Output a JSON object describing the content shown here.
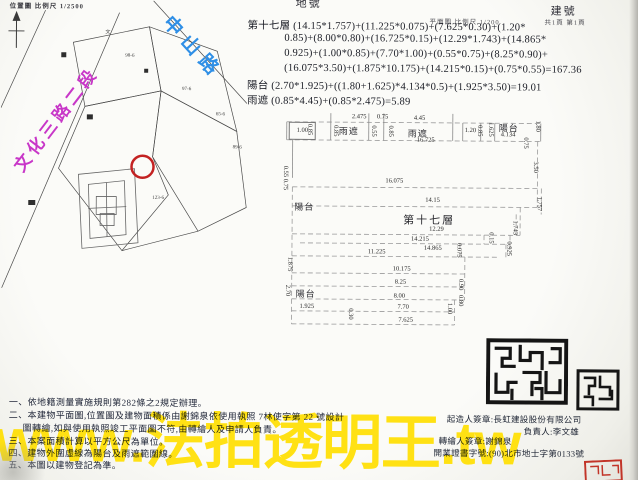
{
  "header": {
    "location_caption": "位置圖 比例尺 1/2500",
    "lot_no_label": "地號",
    "building_no_label": "建號",
    "plan_scale": "平面圖 比例尺 1/200",
    "page_info": "共1頁 第1頁"
  },
  "site_plan": {
    "road_blue": "中山路",
    "road_magenta": "文化三路二段",
    "labels": [
      {
        "t": "文",
        "x": 104,
        "y": 30
      },
      {
        "t": "98-6",
        "x": 124,
        "y": 55
      },
      {
        "t": "97-6",
        "x": 181,
        "y": 88
      },
      {
        "t": "65-6",
        "x": 215,
        "y": 113
      },
      {
        "t": "89-6",
        "x": 232,
        "y": 146
      },
      {
        "t": "123-6",
        "x": 152,
        "y": 197
      }
    ]
  },
  "calc": {
    "lines": [
      {
        "t": "第十七層 (14.15*1.757)+(11.225*0.075)+(7.625*0.30)+(1.20*",
        "x": 246,
        "y": 18
      },
      {
        "t": "0.85)+(8.00*0.80)+(16.725*0.15)+(12.29*1.743)+(14.865*",
        "x": 283,
        "y": 33
      },
      {
        "t": "0.925)+(1.00*0.85)+(7.70*1.00)+(0.55*0.75)+(8.25*0.90)+",
        "x": 283,
        "y": 48
      },
      {
        "t": "(16.075*3.50)+(1.875*10.175)+(14.215*0.15)+(0.75*0.55)=167.36",
        "x": 283,
        "y": 63
      },
      {
        "t": "陽台 (2.70*1.925)+((1.80+1.625)*4.134*0.5)+(1.925*3.50)=19.01",
        "x": 246,
        "y": 78
      },
      {
        "t": "雨遮 (0.85*4.45)+(0.85*2.475)=5.89",
        "x": 246,
        "y": 93
      }
    ]
  },
  "floor_plan": {
    "box_dim": "1.00",
    "labels": [
      {
        "t": "雨遮",
        "x": 338,
        "y": 124
      },
      {
        "t": "雨遮",
        "x": 407,
        "y": 126
      },
      {
        "t": "陽台",
        "x": 498,
        "y": 120
      },
      {
        "t": "陽台",
        "x": 294,
        "y": 200
      },
      {
        "t": "第十七層",
        "x": 403,
        "y": 211,
        "big": 1
      },
      {
        "t": "陽台",
        "x": 296,
        "y": 287
      }
    ],
    "dims": [
      {
        "t": "2.475",
        "x": 351,
        "y": 114
      },
      {
        "t": "0.75",
        "x": 376,
        "y": 114
      },
      {
        "t": "4.45",
        "x": 413,
        "y": 115
      },
      {
        "t": "16.725",
        "x": 416,
        "y": 137
      },
      {
        "t": "0.85",
        "x": 305,
        "y": 124,
        "v": 1
      },
      {
        "t": "0.85",
        "x": 331,
        "y": 125,
        "v": 1
      },
      {
        "t": "0.55",
        "x": 369,
        "y": 125,
        "v": 1
      },
      {
        "t": "0.85",
        "x": 386,
        "y": 125,
        "v": 1
      },
      {
        "t": "1.20",
        "x": 464,
        "y": 127
      },
      {
        "t": "0.85",
        "x": 475,
        "y": 124,
        "v": 1
      },
      {
        "t": "1.625",
        "x": 486,
        "y": 121,
        "v": 1
      },
      {
        "t": "4.134",
        "x": 500,
        "y": 131
      },
      {
        "t": "1.80",
        "x": 533,
        "y": 119,
        "v": 1
      },
      {
        "t": "0.75",
        "x": 521,
        "y": 136,
        "v": 1
      },
      {
        "t": "3.50",
        "x": 531,
        "y": 160,
        "v": 1
      },
      {
        "t": "0.55",
        "x": 281,
        "y": 166,
        "v": 1
      },
      {
        "t": "0.75",
        "x": 281,
        "y": 179,
        "v": 1
      },
      {
        "t": "16.075",
        "x": 385,
        "y": 178
      },
      {
        "t": "14.15",
        "x": 425,
        "y": 197
      },
      {
        "t": "12.29",
        "x": 429,
        "y": 226
      },
      {
        "t": "14.215",
        "x": 411,
        "y": 236
      },
      {
        "t": "14.865",
        "x": 424,
        "y": 245
      },
      {
        "t": "11.225",
        "x": 368,
        "y": 249
      },
      {
        "t": "1.757",
        "x": 535,
        "y": 195,
        "v": 1
      },
      {
        "t": "1.743",
        "x": 511,
        "y": 219,
        "v": 1
      },
      {
        "t": "0.15",
        "x": 487,
        "y": 231,
        "v": 1
      },
      {
        "t": "0.925",
        "x": 505,
        "y": 240,
        "v": 1
      },
      {
        "t": "0.075",
        "x": 455,
        "y": 242,
        "v": 1
      },
      {
        "t": "1.875",
        "x": 286,
        "y": 257,
        "v": 1
      },
      {
        "t": "10.175",
        "x": 393,
        "y": 266
      },
      {
        "t": "8.25",
        "x": 395,
        "y": 279
      },
      {
        "t": "0.90",
        "x": 457,
        "y": 278,
        "v": 1
      },
      {
        "t": "2.70",
        "x": 284,
        "y": 285,
        "v": 1
      },
      {
        "t": "8.00",
        "x": 394,
        "y": 293
      },
      {
        "t": "0.80",
        "x": 457,
        "y": 294,
        "v": 1
      },
      {
        "t": "1.925",
        "x": 300,
        "y": 304
      },
      {
        "t": "7.70",
        "x": 398,
        "y": 304
      },
      {
        "t": "0.30",
        "x": 347,
        "y": 308,
        "v": 1
      },
      {
        "t": "7.625",
        "x": 399,
        "y": 317
      },
      {
        "t": "1.00",
        "x": 446,
        "y": 302,
        "v": 1
      }
    ]
  },
  "notes": {
    "lines": [
      {
        "t": "一、依地籍測量實施規則第282條之2規定辦理。",
        "x": 10,
        "y": 397
      },
      {
        "t": "二、本建物平面圖,位置圖及建物面積係由謝錦泉依使用執照 7林使字第 22 號設計",
        "x": 10,
        "y": 410
      },
      {
        "t": "圖轉繪,如與使用執照竣工平面圖不符,由轉繪人及申請人負責。",
        "x": 24,
        "y": 423
      },
      {
        "t": "三、本案面積計算以平方公尺為單位。",
        "x": 10,
        "y": 436
      },
      {
        "t": "四、建物外圍虛線為陽台及雨遮範圍線。",
        "x": 10,
        "y": 448
      },
      {
        "t": "五、本圖以建物登記為準。",
        "x": 10,
        "y": 460
      }
    ]
  },
  "signature": {
    "lines": [
      {
        "t": "起造人簽章:長虹建設股份有限公司",
        "x": 448,
        "y": 412
      },
      {
        "t": "負責人:李文雄",
        "x": 525,
        "y": 424
      },
      {
        "t": "轉繪人簽章:謝錦泉",
        "x": 440,
        "y": 434
      },
      {
        "t": "開業證書字號:(90)北市地士字第0133號",
        "x": 435,
        "y": 446
      }
    ]
  },
  "watermark": {
    "text": "www.法拍透明王.tw",
    "color": "#ffdf00"
  },
  "colors": {
    "road_blue": "#2f8fe6",
    "road_magenta": "#c837c8",
    "marker_red": "#c32222",
    "seal_black": "#151515",
    "seal_red": "#c23428",
    "watermark_yellow": "#ffdf00"
  }
}
